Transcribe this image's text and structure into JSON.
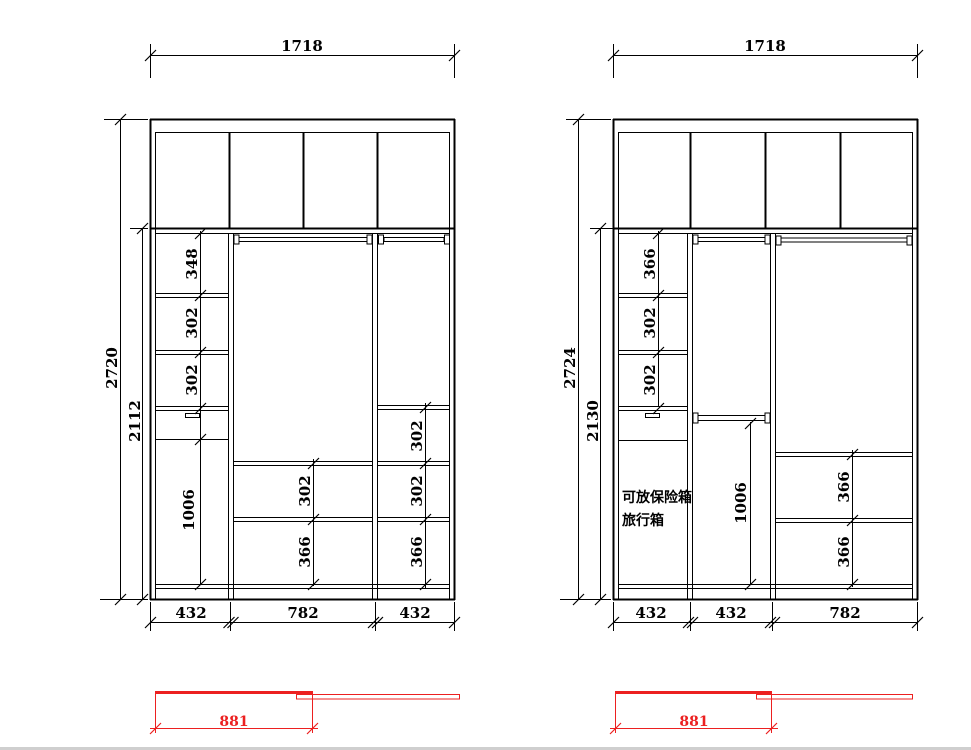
{
  "colors": {
    "line": "#000000",
    "red": "#ec2020",
    "background": "#ffffff",
    "footer_strip": "#cfcfcf"
  },
  "drawings": [
    {
      "width_dim": "1718",
      "overall_height_dim": "2720",
      "inner_height_dim": "2112",
      "left_column_dims": [
        "348",
        "302",
        "302",
        "1006"
      ],
      "middle_column_dims": [
        "302",
        "366"
      ],
      "right_column_dims": [
        "302",
        "302",
        "366"
      ],
      "bottom_dims": [
        "432",
        "782",
        "432"
      ]
    },
    {
      "width_dim": "1718",
      "overall_height_dim": "2724",
      "inner_height_dim": "2130",
      "left_column_dims": [
        "366",
        "302",
        "302"
      ],
      "middle_column_dims": [
        "1006"
      ],
      "right_column_dims": [
        "366",
        "366"
      ],
      "bottom_dims": [
        "432",
        "432",
        "782"
      ],
      "note_line1": "可放保险箱",
      "note_line2": "旅行箱"
    }
  ],
  "door_plans": [
    {
      "width_dim": "881"
    },
    {
      "width_dim": "881"
    }
  ]
}
